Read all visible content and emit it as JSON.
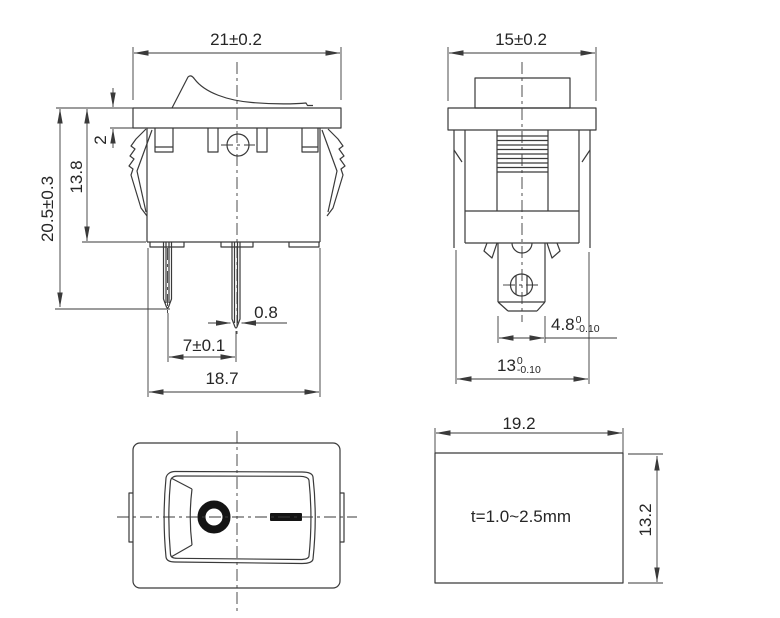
{
  "drawing_title": "rocker switch dimensional drawing",
  "colors": {
    "line": "#3a3a3a",
    "text": "#262626",
    "symbol": "#141414",
    "background": "#ffffff"
  },
  "front_view": {
    "width": "21±0.2",
    "overall_height": "20.5±0.3",
    "body_height": "13.8",
    "flange_thickness": "2",
    "terminal_thickness": "0.8",
    "terminal_pitch": "7±0.1",
    "base_width": "18.7"
  },
  "side_view": {
    "width": "15±0.2",
    "terminal_width": {
      "value": "4.8",
      "tol_upper": "0",
      "tol_lower": "-0.10"
    },
    "body_width": {
      "value": "13",
      "tol_upper": "0",
      "tol_lower": "-0.10"
    }
  },
  "top_view": {
    "off_symbol": "O",
    "on_symbol": "—"
  },
  "panel_cutout": {
    "width": "19.2",
    "height": "13.2",
    "thickness_note": "t=1.0~2.5mm"
  }
}
